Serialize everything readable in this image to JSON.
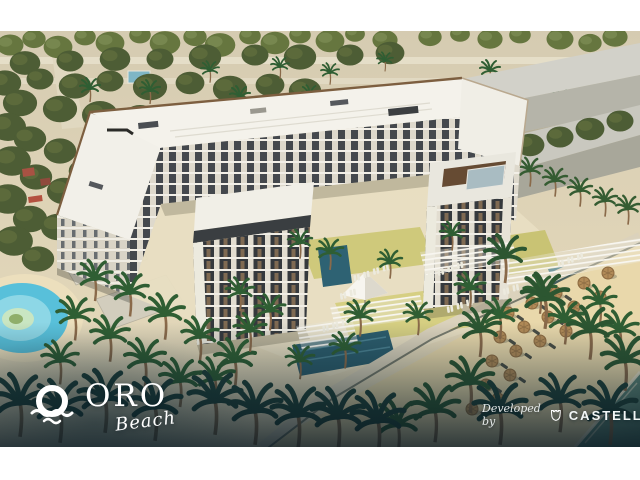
{
  "branding": {
    "project": {
      "name": "ORO",
      "tagline": "Beach",
      "icon": "sun-over-waves-icon"
    },
    "developer": {
      "prefix": "Developed by",
      "name": "CASTELLO",
      "icon": "castle-shield-icon"
    }
  },
  "palette": {
    "frame_white": "#ffffff",
    "desert_sand": "#d8ceb4",
    "beach_sand": "#e9d8ab",
    "roof_white": "#f3f1ea",
    "facade_charcoal": "#3b3f43",
    "facade_light": "#e8e4da",
    "parapet_brown": "#7d5f40",
    "foliage_green": "#2f5e33",
    "olive_tree": "#66763f",
    "lawn_green": "#cfc97b",
    "pool_teal": "#2c5d6d",
    "lagoon_blue": "#58c0da",
    "sea_teal": "#5d8278",
    "umbrella_thatch": "#b18a57",
    "vignette_teal": "#0d2230"
  }
}
